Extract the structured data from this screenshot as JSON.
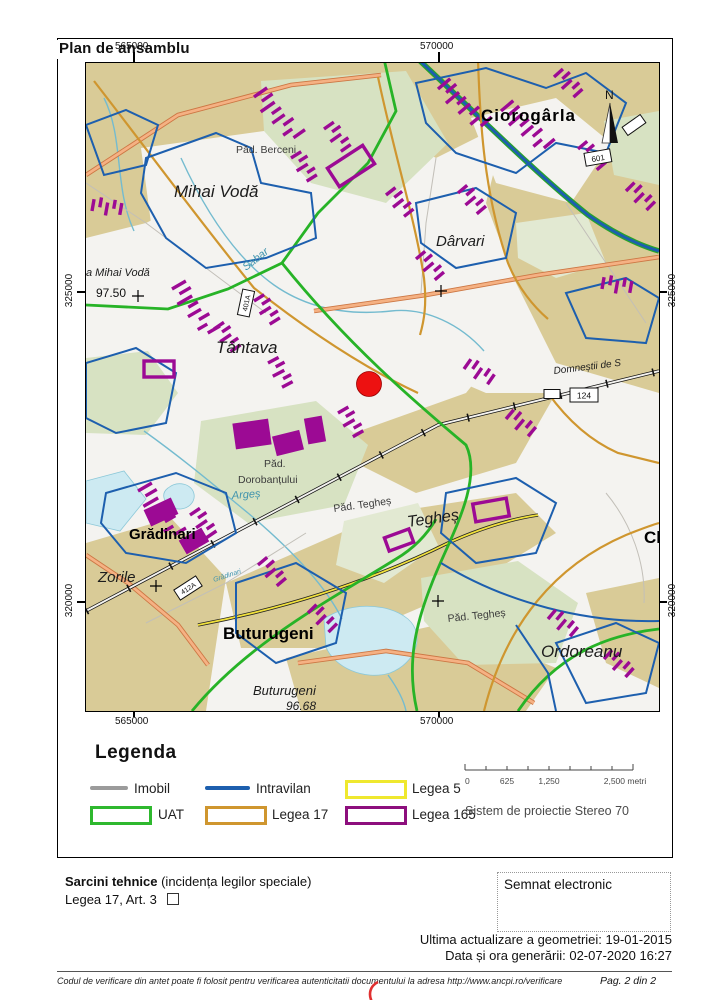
{
  "page": {
    "title": "Plan de ansamblu"
  },
  "map": {
    "grid": {
      "top_left": "565000",
      "top_right": "570000",
      "bottom_left": "565000",
      "bottom_right": "570000",
      "left_top": "325000",
      "left_bottom": "320000",
      "right_top": "325000",
      "right_bottom": "320000"
    },
    "north_label": "N",
    "labels": {
      "pad_berceni": "Păd. Berceni",
      "mihai_voda": "Mihai Vodă",
      "ciorogarla": "Ciorogârla",
      "darvari": "Dârvari",
      "manastirea": "a Mihai Vodă",
      "elev_9750": "97.50",
      "sabar": "Sabar",
      "tantava": "Tântava",
      "domnestii": "Domneștii de S",
      "pad_dor_1": "Păd.",
      "pad_dor_2": "Dorobanțului",
      "arges": "Argeș",
      "pad_teghes_1": "Păd. Tegheș",
      "teghes": "Tegheș",
      "clinceni": "Clinceni",
      "gradinari": "Grădinari",
      "zorile": "Zorile",
      "gradinari_small": "Grădinari",
      "buturugeni": "Buturugeni",
      "pad_teghes_2": "Păd. Tegheș",
      "ordoreanu": "Ordoreanu",
      "buturugeni_it": "Buturugeni",
      "elev_9668": "96.68"
    },
    "shields": {
      "s601": "601",
      "s401a": "401A",
      "s124": "124",
      "s412a": "412A"
    },
    "marker_color": "#ed1111"
  },
  "legend": {
    "title": "Legenda",
    "items": [
      {
        "label": "Imobil",
        "type": "line",
        "color": "#9b9b9b"
      },
      {
        "label": "Intravilan",
        "type": "line",
        "color": "#1d5fae"
      },
      {
        "label": "Legea 5",
        "type": "rect",
        "color": "#efe82e"
      },
      {
        "label": "UAT",
        "type": "rect",
        "color": "#2eb82e"
      },
      {
        "label": "Legea 17",
        "type": "rect",
        "color": "#cf962f"
      },
      {
        "label": "Legea 165",
        "type": "rect",
        "color": "#8d0f7d"
      }
    ],
    "scalebar": {
      "t0": "0",
      "t625": "625",
      "t1250": "1,250",
      "t2500": "2,500 metri"
    },
    "projection": "Sistem de proiectie Stereo 70"
  },
  "footer": {
    "sarcini_bold": "Sarcini tehnice",
    "sarcini_rest": " (incidența legilor speciale)",
    "legea_line": "Legea 17, Art. 3",
    "semnat": "Semnat electronic",
    "update_line": "Ultima actualizare a geometriei: 19-01-2015",
    "generated_line": "Data și ora generării: 02-07-2020 16:27",
    "verification": "Codul de verificare din antet poate fi folosit pentru verificarea autenticitatii documentului la adresa http://www.ancpi.ro/verificare",
    "page_num": "Pag. 2 din  2"
  }
}
